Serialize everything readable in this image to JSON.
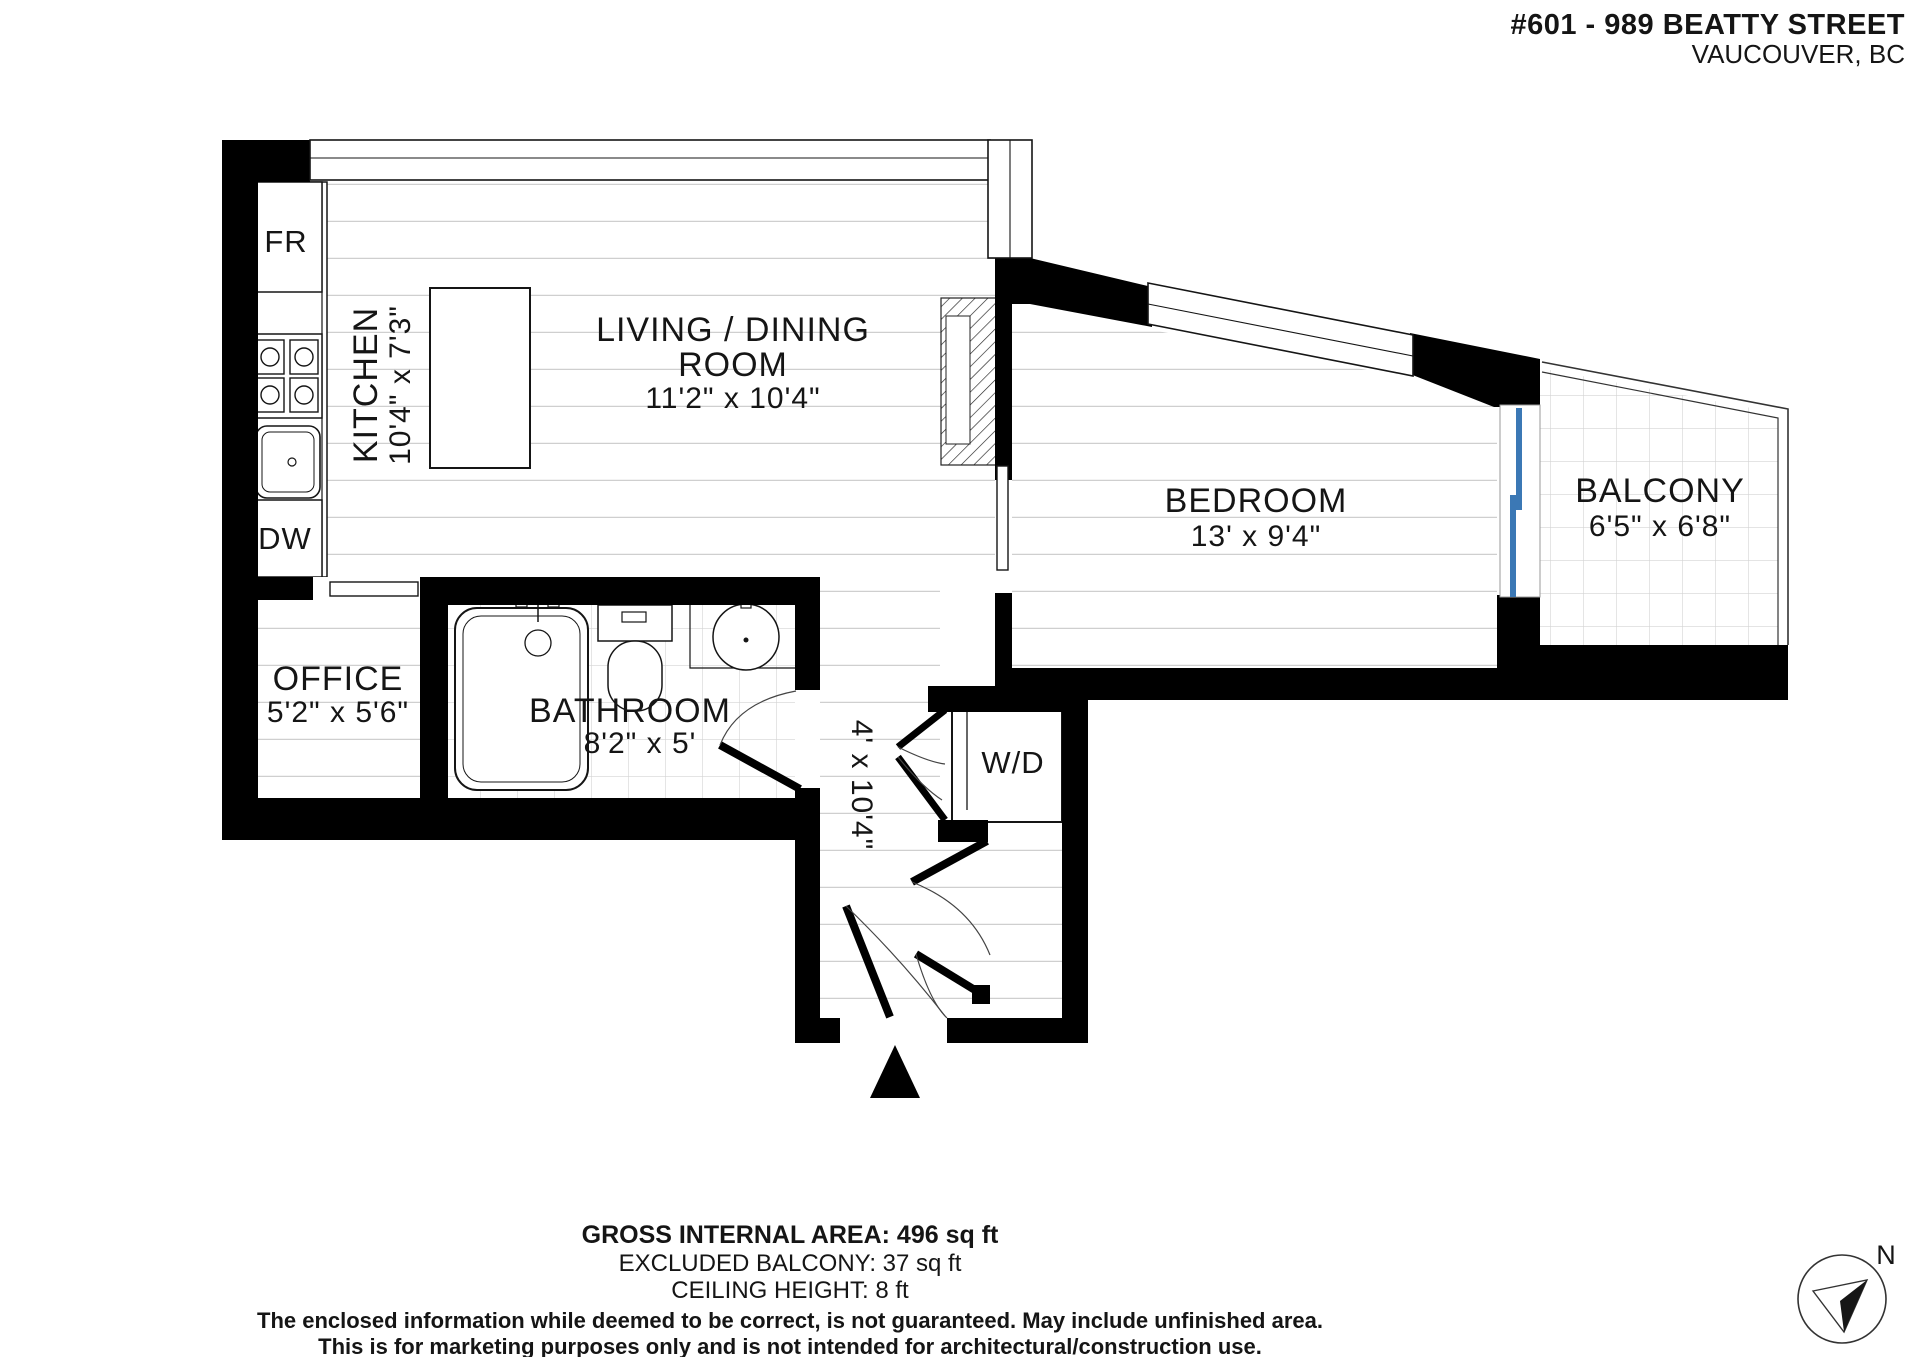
{
  "header": {
    "address_line1": "#601 - 989 BEATTY STREET",
    "address_line2": "VAUCOUVER, BC"
  },
  "rooms": {
    "living": {
      "name_line1": "LIVING / DINING",
      "name_line2": "ROOM",
      "dims": "11'2\" x 10'4\""
    },
    "kitchen": {
      "name": "KITCHEN",
      "dims": "10'4\" x 7'3\""
    },
    "bedroom": {
      "name": "BEDROOM",
      "dims": "13' x 9'4\""
    },
    "balcony": {
      "name": "BALCONY",
      "dims": "6'5\" x 6'8\""
    },
    "office": {
      "name": "OFFICE",
      "dims": "5'2\" x 5'6\""
    },
    "bathroom": {
      "name": "BATHROOM",
      "dims": "8'2\" x 5'"
    },
    "hall": {
      "dims": "4' x 10'4\""
    }
  },
  "labels": {
    "fridge": "FR",
    "dishwasher": "DW",
    "washer_dryer": "W/D"
  },
  "compass": {
    "north": "N"
  },
  "footer": {
    "area_line": "GROSS INTERNAL AREA: 496 sq ft",
    "balcony_line": "EXCLUDED BALCONY: 37 sq ft",
    "ceiling_line": "CEILING HEIGHT: 8 ft",
    "disclaimer_line1": "The enclosed information while deemed to be correct, is not guaranteed. May include unfinished area.",
    "disclaimer_line2": "This is for marketing purposes only and is not intended for architectural/construction use."
  },
  "colors": {
    "wall": "#000000",
    "balcony_door": "#3b78b5",
    "floor_line": "#cfcfcf"
  }
}
